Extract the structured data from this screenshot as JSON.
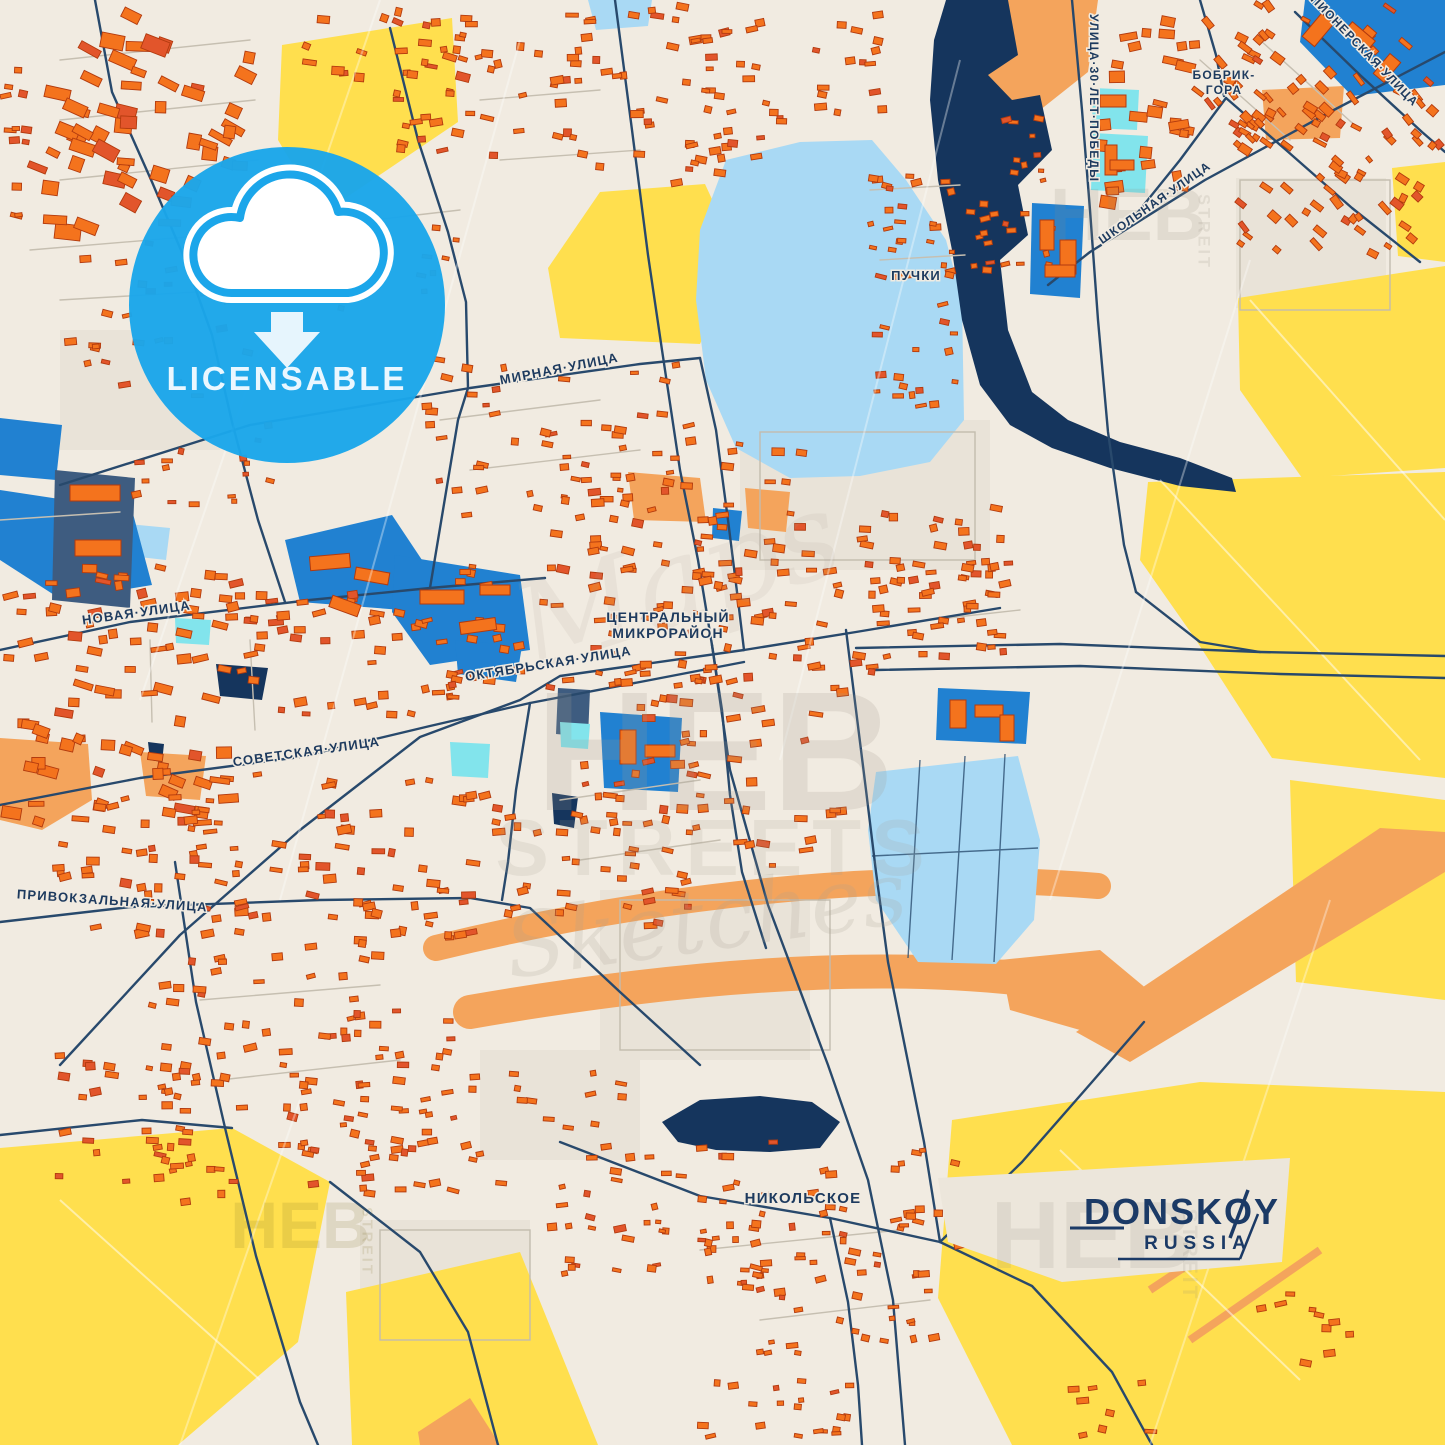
{
  "poster": {
    "title": "DONSKOY",
    "subtitle": "RUSSIA"
  },
  "badge": {
    "label": "LICENSABLE",
    "icon": "cloud-download-icon",
    "color": "#1ba6ea"
  },
  "watermark": {
    "brand": "HEB",
    "brand_side": "STREIT",
    "center_script_top": "Maps",
    "center_main": "HEB",
    "center_sub": "STREETS",
    "center_script": "Sketches"
  },
  "map_labels": [
    {
      "text": "МИРНАЯ·УЛИЦА",
      "type": "street",
      "x": 560,
      "y": 373,
      "rot": -11,
      "size": 13
    },
    {
      "text": "НОВАЯ·УЛИЦА",
      "type": "street",
      "x": 137,
      "y": 617,
      "rot": -8,
      "size": 13
    },
    {
      "text": "СОВЕТСКАЯ·УЛИЦА",
      "type": "street",
      "x": 307,
      "y": 756,
      "rot": -8,
      "size": 13
    },
    {
      "text": "ПРИВОКЗАЛЬНАЯ·УЛИЦА",
      "type": "street",
      "x": 112,
      "y": 905,
      "rot": 4,
      "size": 13
    },
    {
      "text": "ОКТЯБРЬСКАЯ·УЛИЦА",
      "type": "street",
      "x": 549,
      "y": 668,
      "rot": -9,
      "size": 13
    },
    {
      "text": "ШКОЛЬНАЯ·УЛИЦА",
      "type": "street",
      "x": 1157,
      "y": 206,
      "rot": -35,
      "size": 12
    },
    {
      "text": "УЛИЦА·30·ЛЕТ·ПОБЕДЫ",
      "type": "street",
      "x": 1090,
      "y": 14,
      "rot": 90,
      "size": 12
    },
    {
      "text": "ПИОНЕРСКАЯ·УЛИЦА",
      "type": "street",
      "x": 1310,
      "y": 0,
      "rot": 46,
      "size": 12
    },
    {
      "text": "ЦЕНТРАЛЬНЫЙ",
      "type": "place",
      "x": 668,
      "y": 622,
      "rot": 0,
      "size": 14
    },
    {
      "text": "МИКРОРАЙОН",
      "type": "place",
      "x": 668,
      "y": 638,
      "rot": 0,
      "size": 14
    },
    {
      "text": "БОБРИК-",
      "type": "place",
      "x": 1224,
      "y": 79,
      "rot": 0,
      "size": 12
    },
    {
      "text": "ГОРА",
      "type": "place",
      "x": 1224,
      "y": 94,
      "rot": 0,
      "size": 12
    },
    {
      "text": "ПУЧКИ",
      "type": "place",
      "x": 916,
      "y": 280,
      "rot": 0,
      "size": 13
    },
    {
      "text": "НИКОЛЬСКОЕ",
      "type": "place",
      "x": 803,
      "y": 1203,
      "rot": 0,
      "size": 15
    }
  ],
  "colors": {
    "background": "#f1ebe1",
    "field_yellow": "#ffdf4e",
    "sand_orange": "#f4a45c",
    "water_light": "#a9d9f4",
    "water_dark": "#15355d",
    "zone_blue": "#2181d1",
    "zone_cyan": "#82e4ec",
    "zone_slate": "#3e5c80",
    "building_orange": "#f4731d",
    "building_red": "#e2552b",
    "road_navy": "#28496c",
    "label_navy": "#1d3a5e",
    "badge_blue": "#1ba6ea",
    "title_navy": "#1b3a66"
  }
}
